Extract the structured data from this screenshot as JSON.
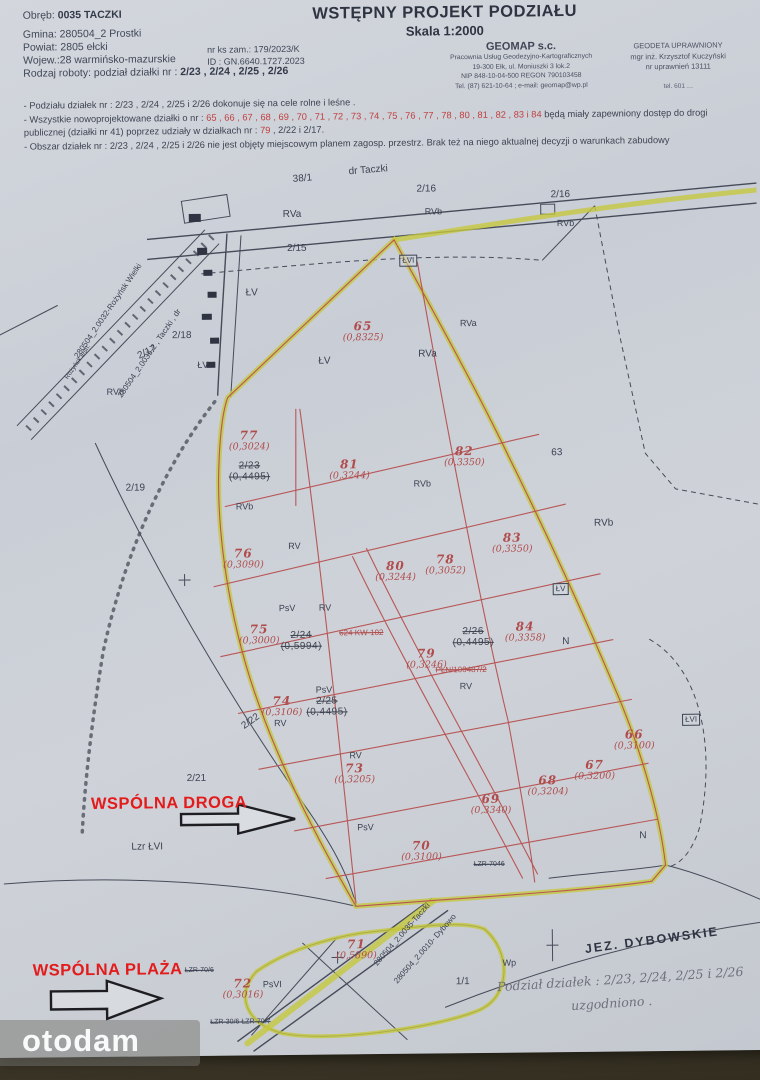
{
  "document": {
    "title": "WSTĘPNY PROJEKT PODZIAŁU",
    "scale": "Skala 1:2000",
    "info": {
      "obreb_label": "Obręb: ",
      "obreb_value": "0035  TACZKI",
      "gmina": "Gmina: 280504_2 Prostki",
      "powiat": "Powiat: 2805 ełcki",
      "wojew": "Wojew.:28 warmińsko-mazurskie",
      "rodzaj_label": "Rodzaj roboty: podział działki nr : ",
      "rodzaj_value": "2/23 , 2/24 , 2/25 , 2/26",
      "nr_zam": "nr ks zam.:    179/2023/K",
      "id": "ID : GN.6640.1727.2023"
    },
    "firm": {
      "name": "GEOMAP s.c.",
      "line1": "Pracownia Usług Geodezyjno-Kartograficznych",
      "line2": "19-300 Ełk, ul. Moniuszki 3 lok.2",
      "line3": "NIP 848-10-04-500  REGON 790103458",
      "line4": "Tel. (87) 621-10-64 ; e-mail: geomap@wp.pl"
    },
    "surveyor": {
      "line1": "GEODETA UPRAWNIONY",
      "line2": "mgr inż. Krzysztof Kuczyński",
      "line3": "nr uprawnień 13111",
      "line4": "tel. 601 …"
    },
    "notes": {
      "n1": "- Podziału działek  nr : 2/23 , 2/24 , 2/25 i 2/26  dokonuje się na cele rolne i leśne .",
      "n2a": "- Wszystkie nowoprojektowane działki o nr : ",
      "n2_red": "65 , 66 , 67 , 68 , 69 , 70 , 71 , 72 , 73 , 74 , 75 , 76 , 77 , 78 , 80 , 81 , 82 , 83 i 84",
      "n2b": " będą miały zapewniony  dostęp do drogi publicznej (działki nr 41) poprzez udziały w działkach nr : ",
      "n2_red2": "79",
      "n2c": " , 2/22 i 2/17.",
      "n3": "- Obszar działek  nr : 2/23 , 2/24 , 2/25 i 2/26  nie jest objęty miejscowym planem  zagosp. przestrz.  Brak też na niego aktualnej decyzji o warunkach zabudowy"
    },
    "handwritten": {
      "line1": "Podział działek : 2/23, 2/24, 2/25 i 2/26",
      "line2": "uzgodniono ."
    }
  },
  "map": {
    "common_road_label": "WSPÓLNA DROGA",
    "common_beach_label": "WSPÓLNA PLAŻA",
    "lake_label": "JEZ. DYBOWSKIE",
    "colors": {
      "highlight": "#c5c83e",
      "parcel_red": "#b04c4c",
      "accent_red": "#e31b1b"
    },
    "parcels": [
      {
        "n": "65",
        "a": "(0,8325)",
        "x": 365,
        "y": 320
      },
      {
        "n": "77",
        "a": "(0,3024)",
        "x": 250,
        "y": 428
      },
      {
        "n": "81",
        "a": "(0,3244)",
        "x": 350,
        "y": 458
      },
      {
        "n": "82",
        "a": "(0,3350)",
        "x": 465,
        "y": 446
      },
      {
        "n": "83",
        "a": "(0,3350)",
        "x": 512,
        "y": 533
      },
      {
        "n": "76",
        "a": "(0,3090)",
        "x": 243,
        "y": 546
      },
      {
        "n": "80",
        "a": "(0,3244)",
        "x": 395,
        "y": 560
      },
      {
        "n": "78",
        "a": "(0,3052)",
        "x": 445,
        "y": 554
      },
      {
        "n": "75",
        "a": "(0,3000)",
        "x": 258,
        "y": 622
      },
      {
        "n": "84",
        "a": "(0,3358)",
        "x": 524,
        "y": 622
      },
      {
        "n": "79",
        "a": "(0,3246)",
        "x": 425,
        "y": 648
      },
      {
        "n": "74",
        "a": "(0,3106)",
        "x": 280,
        "y": 694
      },
      {
        "n": "73",
        "a": "(0,3205)",
        "x": 352,
        "y": 762
      },
      {
        "n": "66",
        "a": "(0,3100)",
        "x": 632,
        "y": 731
      },
      {
        "n": "67",
        "a": "(0,3200)",
        "x": 592,
        "y": 761
      },
      {
        "n": "68",
        "a": "(0,3204)",
        "x": 545,
        "y": 776
      },
      {
        "n": "69",
        "a": "(0,3340)",
        "x": 488,
        "y": 794
      },
      {
        "n": "70",
        "a": "(0,3100)",
        "x": 418,
        "y": 840
      },
      {
        "n": "71",
        "a": "(0,5890)",
        "x": 352,
        "y": 938
      },
      {
        "n": "72",
        "a": "(0,3016)",
        "x": 238,
        "y": 976
      },
      {
        "n": "2/23",
        "a": "(0,4495)",
        "x": 250,
        "y": 460,
        "old": true
      },
      {
        "n": "2/24",
        "a": "(0,5994)",
        "x": 300,
        "y": 630,
        "old": true
      },
      {
        "n": "2/25",
        "a": "(0,4495)",
        "x": 325,
        "y": 696,
        "old": true
      },
      {
        "n": "2/26",
        "a": "(0,4495)",
        "x": 472,
        "y": 628,
        "old": true
      }
    ],
    "labels": [
      {
        "t": "38/1",
        "x": 296,
        "y": 174,
        "r": -4
      },
      {
        "t": "dr  Taczki",
        "x": 352,
        "y": 167,
        "r": -4
      },
      {
        "t": "2/16",
        "x": 420,
        "y": 185
      },
      {
        "t": "RVb",
        "x": 428,
        "y": 208,
        "s": 9
      },
      {
        "t": "2/16",
        "x": 554,
        "y": 192
      },
      {
        "t": "RVb",
        "x": 560,
        "y": 221,
        "s": 9
      },
      {
        "t": "RVa",
        "x": 286,
        "y": 209
      },
      {
        "t": "2/15",
        "x": 290,
        "y": 243
      },
      {
        "t": "ŁVI",
        "x": 402,
        "y": 255,
        "b": 1,
        "s": 8
      },
      {
        "t": "ŁV",
        "x": 248,
        "y": 287
      },
      {
        "t": "2/18",
        "x": 174,
        "y": 329
      },
      {
        "t": "ŁV",
        "x": 199,
        "y": 359,
        "s": 9
      },
      {
        "t": "2/17",
        "x": 138,
        "y": 350,
        "r": -25
      },
      {
        "t": "RVb",
        "x": 108,
        "y": 385,
        "s": 9
      },
      {
        "t": "RVa",
        "x": 420,
        "y": 350
      },
      {
        "t": "RVa",
        "x": 462,
        "y": 320,
        "s": 9
      },
      {
        "t": "ŁV",
        "x": 320,
        "y": 356
      },
      {
        "t": "2/19",
        "x": 126,
        "y": 481
      },
      {
        "t": "RVb",
        "x": 236,
        "y": 501,
        "s": 9
      },
      {
        "t": "RVb",
        "x": 414,
        "y": 480,
        "s": 9
      },
      {
        "t": "63",
        "x": 552,
        "y": 450
      },
      {
        "t": "RVb",
        "x": 594,
        "y": 521
      },
      {
        "t": "RV",
        "x": 288,
        "y": 541,
        "s": 9
      },
      {
        "t": "PsV",
        "x": 278,
        "y": 603,
        "s": 9
      },
      {
        "t": "RV",
        "x": 318,
        "y": 603,
        "s": 9
      },
      {
        "t": "N",
        "x": 561,
        "y": 639
      },
      {
        "t": "RV",
        "x": 458,
        "y": 683,
        "s": 9
      },
      {
        "t": "PsV",
        "x": 314,
        "y": 685,
        "s": 9
      },
      {
        "t": "RV",
        "x": 272,
        "y": 718,
        "s": 9
      },
      {
        "t": "2/22",
        "x": 238,
        "y": 722,
        "r": -35
      },
      {
        "t": "RV",
        "x": 347,
        "y": 751,
        "s": 9
      },
      {
        "t": "ŁV",
        "x": 552,
        "y": 585,
        "b": 1,
        "s": 8
      },
      {
        "t": "ŁVI",
        "x": 680,
        "y": 717,
        "b": 1,
        "s": 8
      },
      {
        "t": "N",
        "x": 636,
        "y": 834
      },
      {
        "t": "2/21",
        "x": 184,
        "y": 772
      },
      {
        "t": "Lzr ŁVI",
        "x": 128,
        "y": 840
      },
      {
        "t": "PsV",
        "x": 354,
        "y": 823,
        "s": 9
      },
      {
        "t": "ŁZR-7046",
        "x": 470,
        "y": 862,
        "s": 7,
        "k": 1
      },
      {
        "t": "624 KW-102",
        "x": 338,
        "y": 629,
        "s": 8,
        "k": 1,
        "c": "#b04c4c"
      },
      {
        "t": "PŁN/100487/2",
        "x": 434,
        "y": 667,
        "s": 8,
        "k": 1,
        "c": "#b04c4c"
      },
      {
        "t": "280504_2.0032-Rożyńsk Wielki",
        "x": 75,
        "y": 352,
        "r": -55,
        "s": 8
      },
      {
        "t": "Rożyńsk  leśn.",
        "x": 66,
        "y": 374,
        "r": -55,
        "s": 6.5
      },
      {
        "t": "280504_2.0035-2 , Taczki , dr",
        "x": 118,
        "y": 392,
        "r": -55,
        "s": 8
      },
      {
        "t": "280504_2.0035-Taczki",
        "x": 368,
        "y": 962,
        "r": -48,
        "s": 8
      },
      {
        "t": "280504_2.0010- Dybowo",
        "x": 388,
        "y": 980,
        "r": -48,
        "s": 8
      },
      {
        "t": "Wp",
        "x": 498,
        "y": 960,
        "s": 9
      },
      {
        "t": "1/1",
        "x": 451,
        "y": 978
      },
      {
        "t": "PsVI",
        "x": 258,
        "y": 979,
        "s": 9
      },
      {
        "t": "ŁZR-70/6",
        "x": 180,
        "y": 965,
        "s": 7,
        "k": 1
      },
      {
        "t": "ŁZR-30/6  ŁZR-70/7",
        "x": 205,
        "y": 1017,
        "s": 7,
        "k": 1
      }
    ]
  },
  "watermark": {
    "text": "otodam"
  }
}
